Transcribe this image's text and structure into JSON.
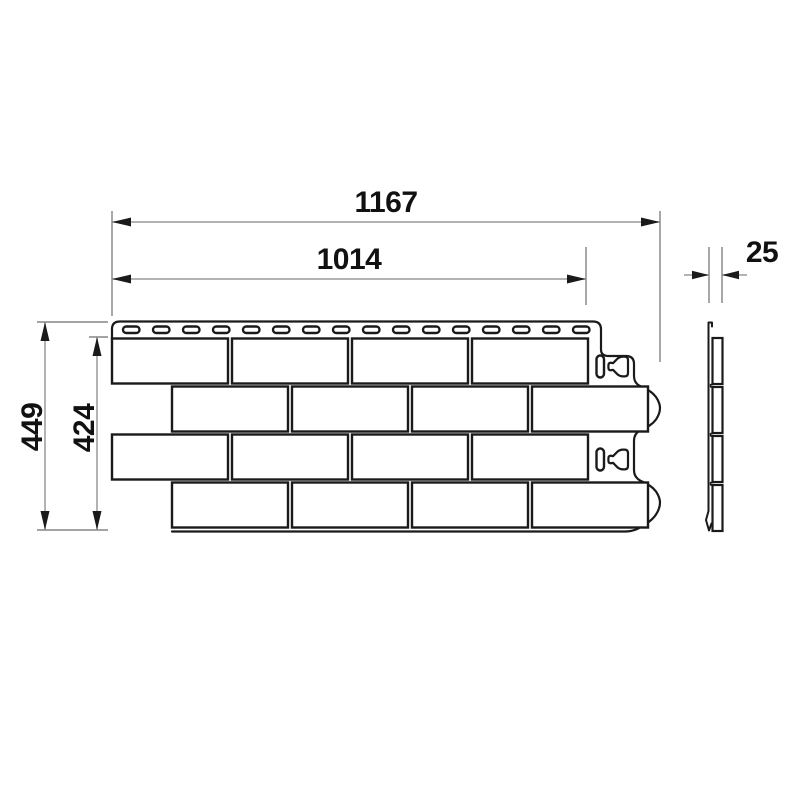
{
  "drawing": {
    "type": "facade-panel-technical-drawing",
    "dimensions": {
      "overall_width": "1167",
      "working_width": "1014",
      "thickness": "25",
      "overall_height": "449",
      "working_height": "424"
    },
    "panel": {
      "brick_rows": 4,
      "bricks_per_full_row": 4,
      "nail_slots": 16,
      "lock_holes": 2
    },
    "colors": {
      "outline": "#1a1a1a",
      "dimension_line": "#9a9a9a",
      "extension_line": "#6e6e6e",
      "text": "#111111",
      "background": "#ffffff"
    }
  }
}
